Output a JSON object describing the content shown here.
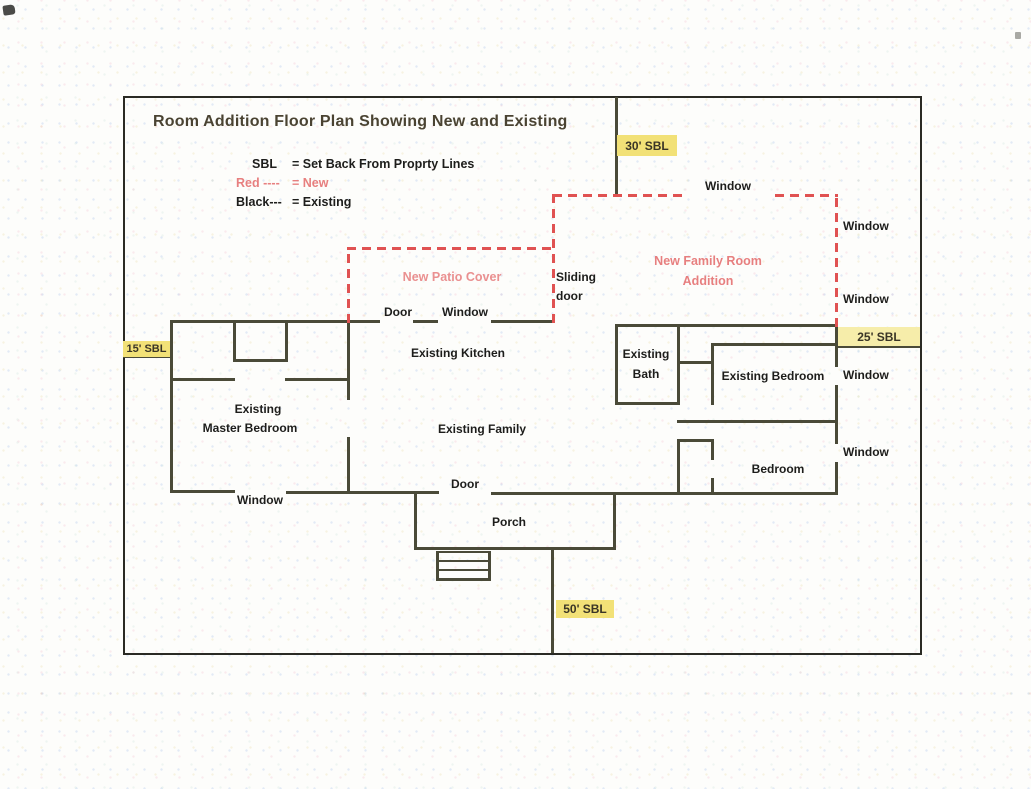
{
  "title": "Room Addition Floor Plan Showing New and Existing",
  "legend": {
    "row1_term": "SBL",
    "row1_def": "= Set Back From Proprty Lines",
    "row2_term": "Red ----",
    "row2_def": "= New",
    "row3_term": "Black---",
    "row3_def": "= Existing"
  },
  "setbacks": {
    "top": "30' SBL",
    "left": "15' SBL",
    "right": "25' SBL",
    "bottom": "50' SBL"
  },
  "new_areas": {
    "patio": "New Patio Cover",
    "family_line1": "New Family Room",
    "family_line2": "Addition"
  },
  "rooms": {
    "kitchen": "Existing Kitchen",
    "family": "Existing Family",
    "master_line1": "Existing",
    "master_line2": "Master Bedroom",
    "bath_line1": "Existing",
    "bath_line2": "Bath",
    "bedroom_existing": "Existing Bedroom",
    "bedroom": "Bedroom",
    "porch": "Porch"
  },
  "openings": {
    "door_top": "Door",
    "window_top_wall": "Window",
    "door_bottom": "Door",
    "window_bottom": "Window",
    "sliding_line1": "Sliding",
    "sliding_line2": "door",
    "window_addition_top": "Window",
    "window_addition_right1": "Window",
    "window_addition_right2": "Window",
    "window_bedroom_existing": "Window",
    "window_bedroom": "Window"
  },
  "colors": {
    "new_line": "#e05252",
    "new_text": "#e77f7f",
    "existing_line": "#4a4a38",
    "highlight": "#f2e177"
  }
}
